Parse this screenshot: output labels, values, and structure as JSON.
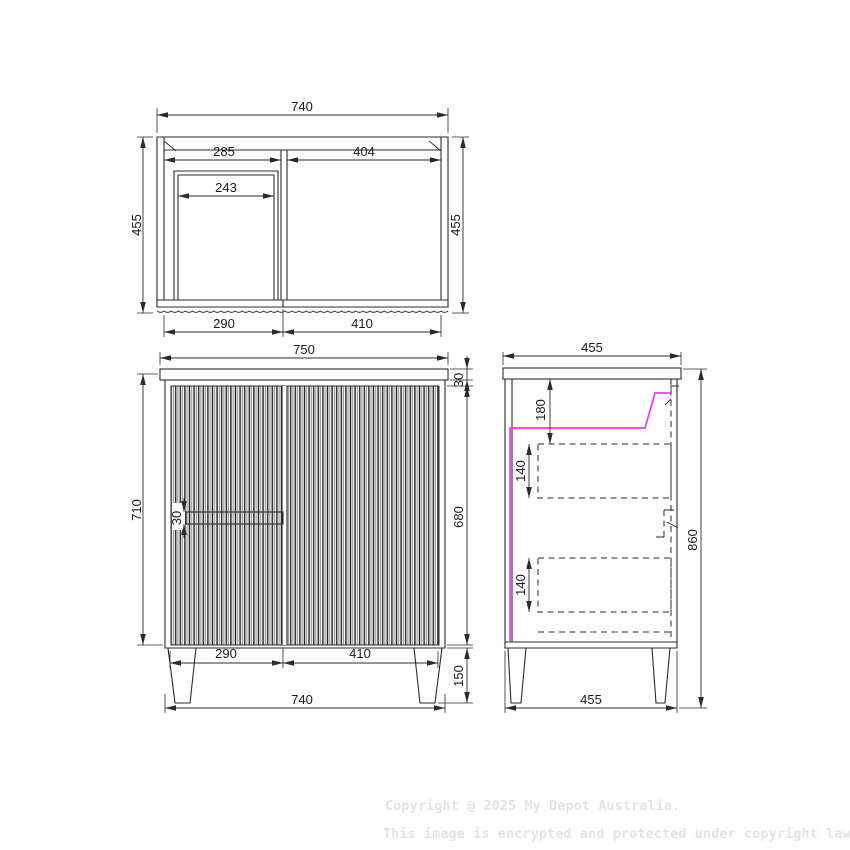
{
  "views": {
    "plan": {
      "label": "top-view-of-cabinet",
      "dims": {
        "overall_width": "740",
        "depth_left": "455",
        "depth_right": "455",
        "opening_left": "285",
        "opening_right": "404",
        "inner_clear": "243",
        "door_left": "290",
        "door_right": "410"
      }
    },
    "front": {
      "label": "front-view-of-cabinet",
      "dims": {
        "top_width": "750",
        "height_no_legs": "710",
        "benchtop_thickness": "30",
        "handle_height": "30",
        "door_height": "680",
        "door_left": "290",
        "door_right": "410",
        "leg_height": "150",
        "bottom_width": "740"
      }
    },
    "side": {
      "label": "side-section-view-of-cabinet",
      "dims": {
        "top_depth": "455",
        "basin_clearance": "180",
        "drawer_top": "140",
        "drawer_bottom": "140",
        "overall_height": "860",
        "bottom_depth": "455"
      }
    }
  },
  "watermark": {
    "line1": "Copyright @ 2025 My Depot Australia.",
    "line2": "This image is encrypted and protected under copyright law."
  },
  "colors": {
    "line": "#2b2b2b",
    "accent_magenta": "#e93ce9",
    "watermark_gray": "#e3e3e3"
  }
}
